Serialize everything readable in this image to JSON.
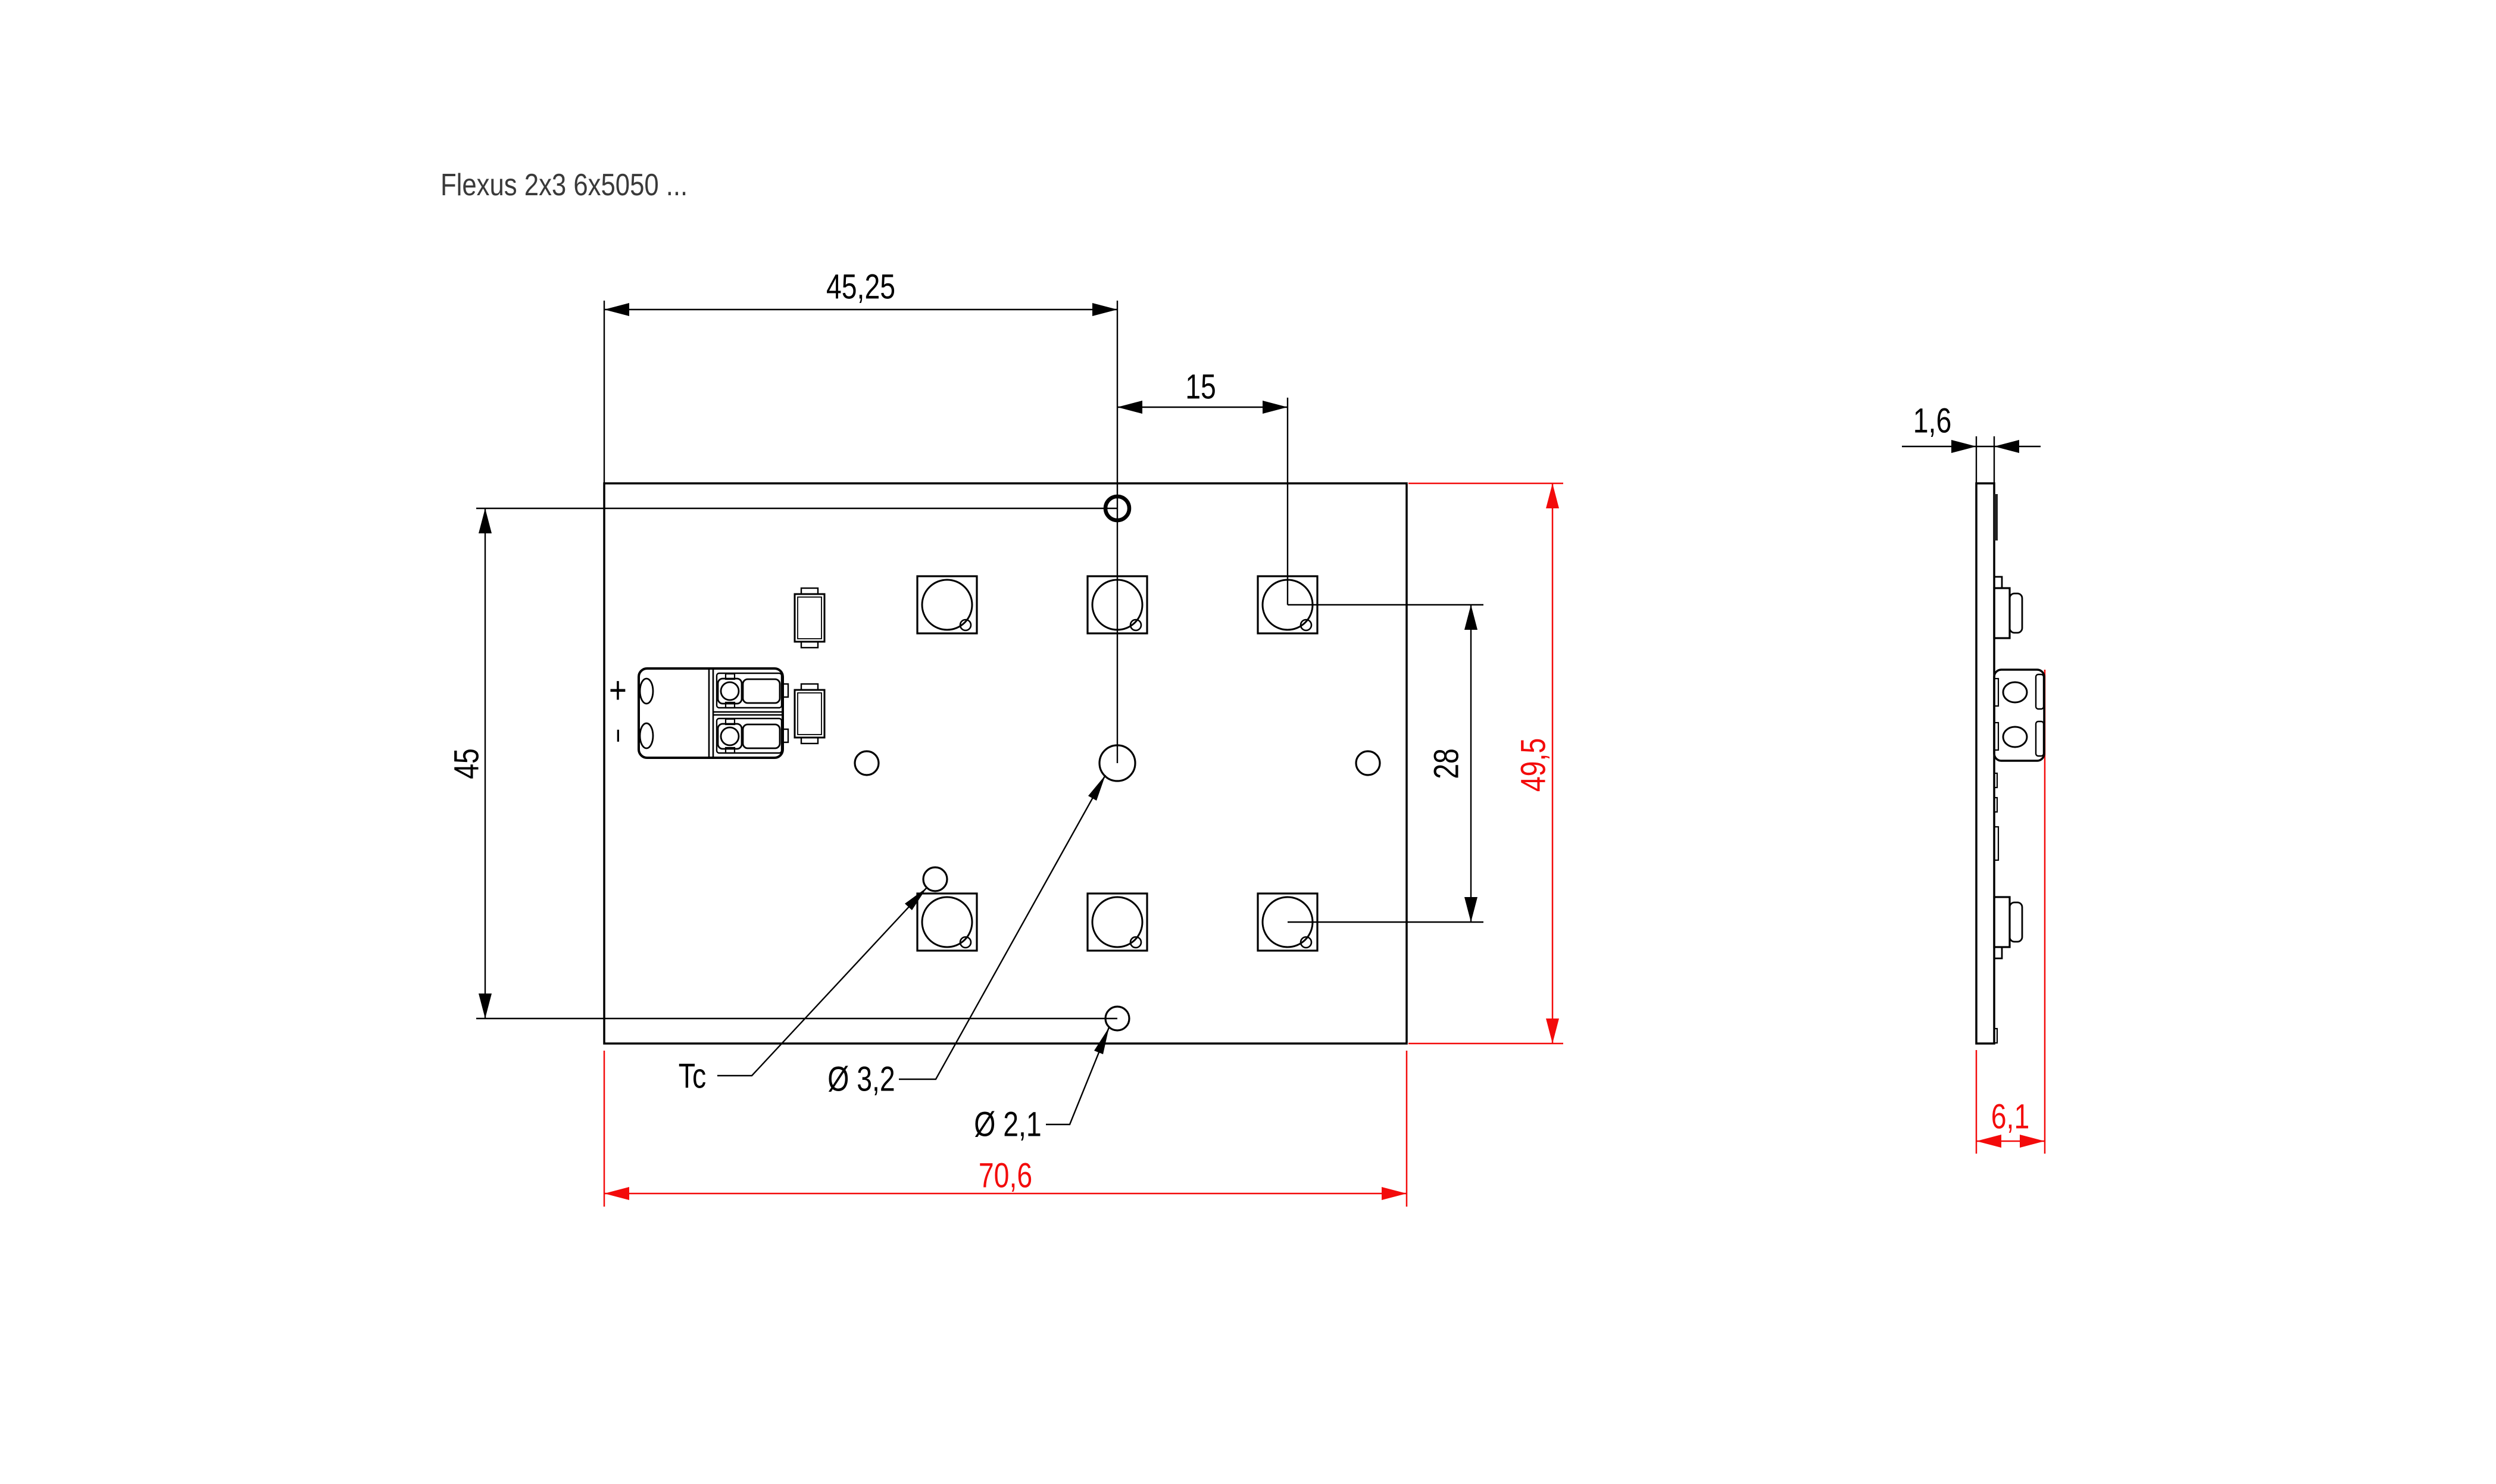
{
  "title": "Flexus 2x3 6x5050 ...",
  "colors": {
    "dimension_red": "#f30b0b",
    "line_black": "#000000"
  },
  "front_view": {
    "dims": {
      "left_edge_to_hole": "45,25",
      "hole_to_led_column": "15",
      "hole_spacing": "45",
      "led_row_spacing": "28",
      "board_height": "49,5",
      "board_width": "70,6"
    },
    "labels": {
      "thermal_point": "Tc",
      "center_hole_diameter": "Ø 3,2",
      "mount_hole_diameter": "Ø 2,1",
      "polarity_positive": "+",
      "polarity_negative": "−"
    }
  },
  "side_view": {
    "dims": {
      "pcb_thickness": "1,6",
      "overall_height": "6,1"
    }
  }
}
